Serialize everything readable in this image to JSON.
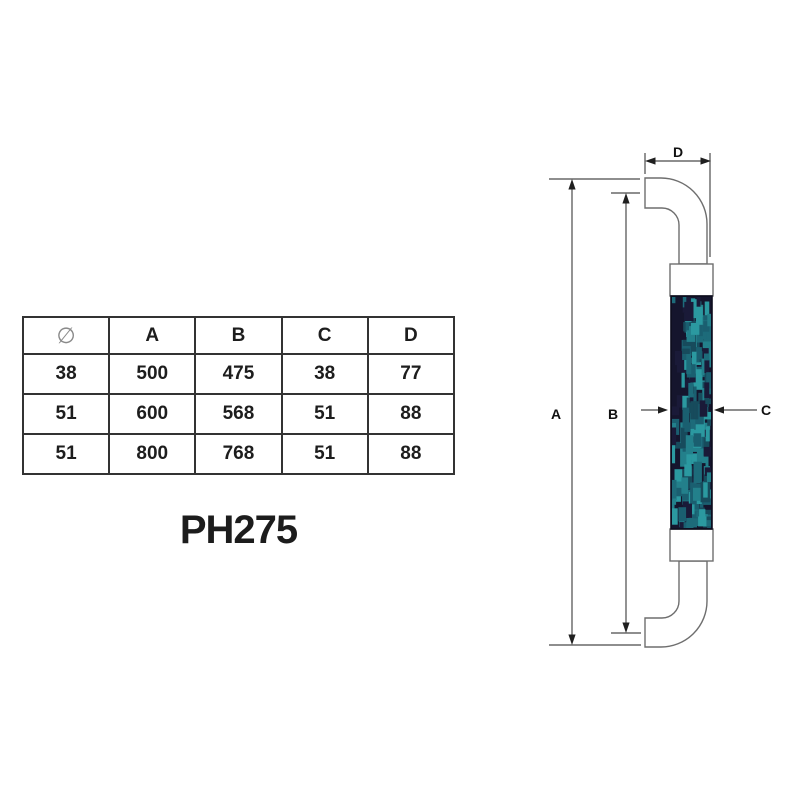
{
  "model_label": "PH275",
  "spec_table": {
    "headers": [
      "∅",
      "A",
      "B",
      "C",
      "D"
    ],
    "rows": [
      [
        "38",
        "500",
        "475",
        "38",
        "77"
      ],
      [
        "51",
        "600",
        "568",
        "51",
        "88"
      ],
      [
        "51",
        "800",
        "768",
        "51",
        "88"
      ]
    ]
  },
  "drawing": {
    "dimension_labels": {
      "a": "A",
      "b": "B",
      "c": "C",
      "d": "D"
    },
    "colors": {
      "outline": "#6e6e6e",
      "dimension_line": "#4b4b4b",
      "arrowhead": "#1f1f1f",
      "label_text": "#111111",
      "table_border": "#333333",
      "table_text": "#1d1d1d",
      "diameter_color": "#8a8a8a",
      "collar_fill": "#ffffff",
      "grip_base": "#15152d",
      "grip_edge": "#0d0d1d",
      "grip_pattern": [
        "#174b5c",
        "#1a5f70",
        "#23808b",
        "#2b99a0",
        "#1d6b7a",
        "#1a1a38"
      ]
    }
  }
}
